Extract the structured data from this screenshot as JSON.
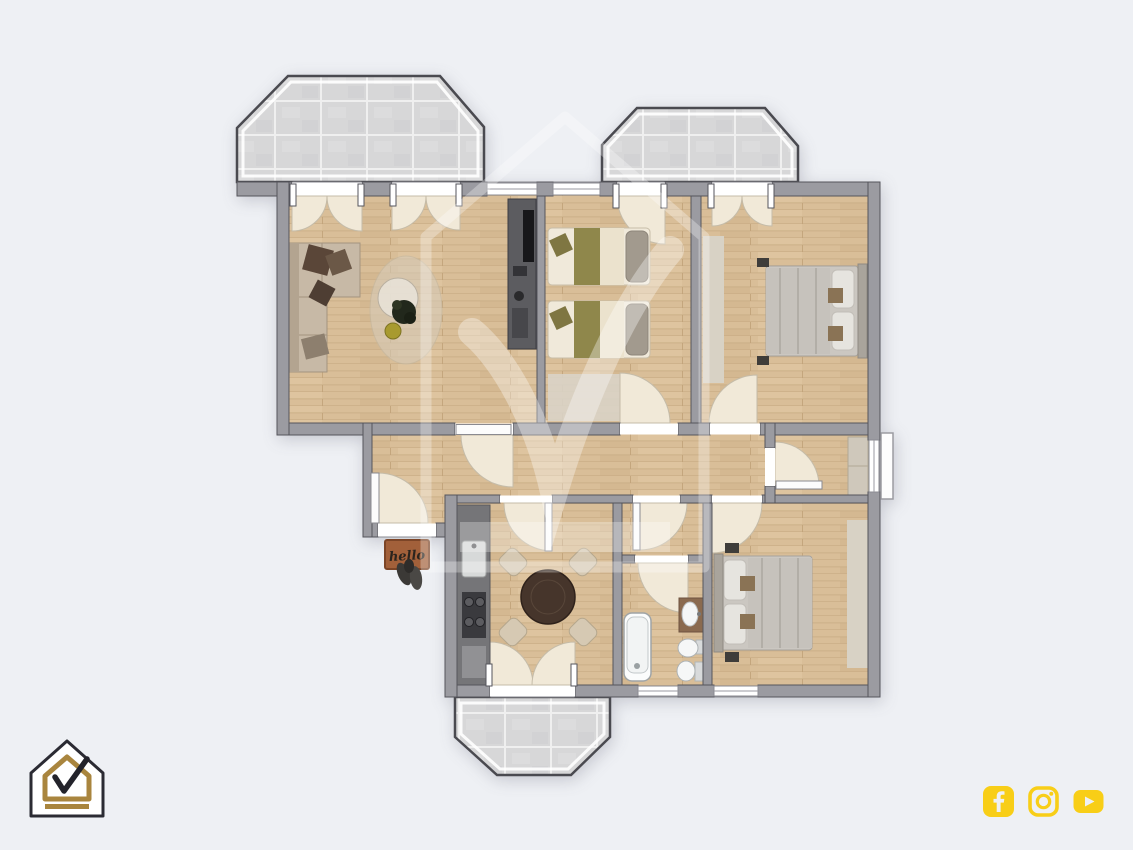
{
  "canvas": {
    "width": 1133,
    "height": 850,
    "background": "#eef0f4"
  },
  "watermark": {
    "name": "house-check-watermark",
    "color": "#ffffff",
    "opacity": 0.32
  },
  "logo": {
    "name": "house-check-brand-logo",
    "fill": "#ffffff",
    "outline": "#2b2b33",
    "accent_gold": "#a9853e",
    "check_color": "#23232b"
  },
  "social": {
    "color": "#f8ce17",
    "icons": [
      {
        "name": "facebook"
      },
      {
        "name": "instagram"
      },
      {
        "name": "youtube"
      }
    ]
  },
  "floorplan": {
    "entry_mat_text": "hello",
    "palette": {
      "wall": "#9b9ba1",
      "wall_line": "#55555c",
      "wood": "#d9be98",
      "wood_seam": "#c8ab83",
      "tile": "#d7d7d8",
      "tile_line": "#efefef",
      "door_swing": "#f1e9d8",
      "door_leaf": "#fcfcfc",
      "window": "#ffffff",
      "rug": "#d8d2c5",
      "sofa": "#c7b9a6",
      "pillow_dark": "#5a4638",
      "olive": "#8f874b",
      "bedding_light": "#f0e9da",
      "duvet_gray": "#c6c2bc",
      "headboard": "#a9a49c",
      "counter": "#757578",
      "stove": "#3a3a3e",
      "table": "#46352b",
      "chair": "#d6c9b3",
      "fixture": "#fbfcfc",
      "vanity": "#8a6a4f",
      "tv_unit": "#5c5c60",
      "mat": "#a2603a",
      "wardrobe": "#cfc8bb"
    },
    "rooms": [
      {
        "name": "balcony-top-left",
        "type": "balcony",
        "furniture": []
      },
      {
        "name": "balcony-top-right",
        "type": "balcony",
        "furniture": []
      },
      {
        "name": "balcony-bottom",
        "type": "balcony",
        "furniture": []
      },
      {
        "name": "living-room",
        "type": "room",
        "furniture": [
          "corner-sofa",
          "throw-pillows",
          "area-rug",
          "coffee-table",
          "plant",
          "tv-unit"
        ]
      },
      {
        "name": "bedroom-twin",
        "type": "room",
        "furniture": [
          "single-bed",
          "single-bed",
          "rug"
        ]
      },
      {
        "name": "bedroom-master",
        "type": "room",
        "furniture": [
          "double-bed",
          "rug",
          "nightstands"
        ]
      },
      {
        "name": "hallway",
        "type": "circulation",
        "furniture": []
      },
      {
        "name": "entry",
        "type": "circulation",
        "furniture": [
          "doormat",
          "shoes"
        ]
      },
      {
        "name": "kitchen-dining",
        "type": "room",
        "furniture": [
          "kitchen-counter",
          "sink",
          "stove",
          "round-dining-table",
          "four-chairs"
        ]
      },
      {
        "name": "bathroom",
        "type": "room",
        "furniture": [
          "bathtub",
          "vanity-sink",
          "bidet",
          "toilet"
        ]
      },
      {
        "name": "bedroom-second",
        "type": "room",
        "furniture": [
          "double-bed",
          "rug",
          "wardrobe"
        ]
      }
    ]
  }
}
